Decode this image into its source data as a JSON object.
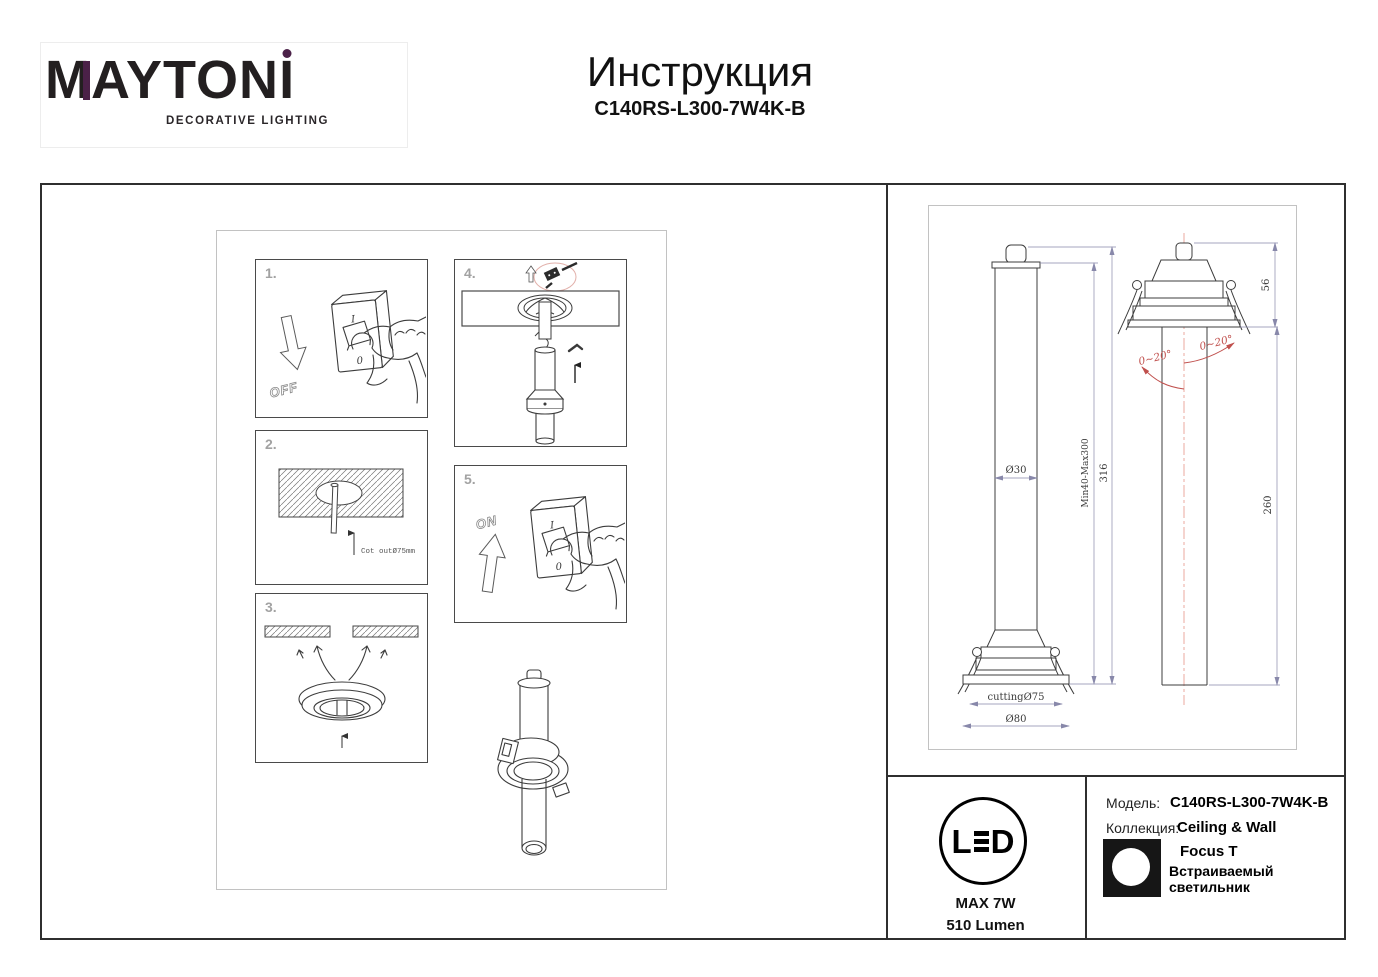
{
  "header": {
    "logo": {
      "brand_m": "M",
      "brand_mid": "AYTON",
      "brand_i": "I",
      "tagline": "DECORATIVE LIGHTING",
      "accent_color": "#4b2148"
    },
    "title": "Инструкция",
    "model": "C140RS-L300-7W4K-B"
  },
  "steps": {
    "s1": {
      "num": "1.",
      "arrow_label": "OFF",
      "switch_on": "I",
      "switch_off": "0"
    },
    "s2": {
      "num": "2.",
      "cutout_note": "Cot outØ75mm"
    },
    "s3": {
      "num": "3."
    },
    "s4": {
      "num": "4."
    },
    "s5": {
      "num": "5.",
      "arrow_label": "ON"
    }
  },
  "drawings": {
    "front_view": {
      "tube_diameter": "Ø30",
      "adjust_range": "Min40-Max300",
      "total_height": "316",
      "cutting_hole": "cuttingØ75",
      "outer_diameter": "Ø80"
    },
    "tilt_view": {
      "recess_depth": "56",
      "tube_length": "260",
      "tilt_left": "0~20°",
      "tilt_right": "0~20°"
    }
  },
  "footer": {
    "led": {
      "letter_l": "L",
      "letter_d": "D",
      "max_power": "MAX 7W",
      "lumen": "510 Lumen"
    },
    "product": {
      "model_label": "Модель:",
      "model_value": "C140RS-L300-7W4K-B",
      "collection_label": "Коллекция:",
      "collection_value": "Ceiling & Wall",
      "series": "Focus T",
      "type": "Встраиваемый светильник"
    }
  },
  "colors": {
    "cad_dim_line": "#8888aa",
    "cad_red": "#c0504d",
    "centerline_red": "#eba89f",
    "sketch_line": "#3c3c3c"
  }
}
